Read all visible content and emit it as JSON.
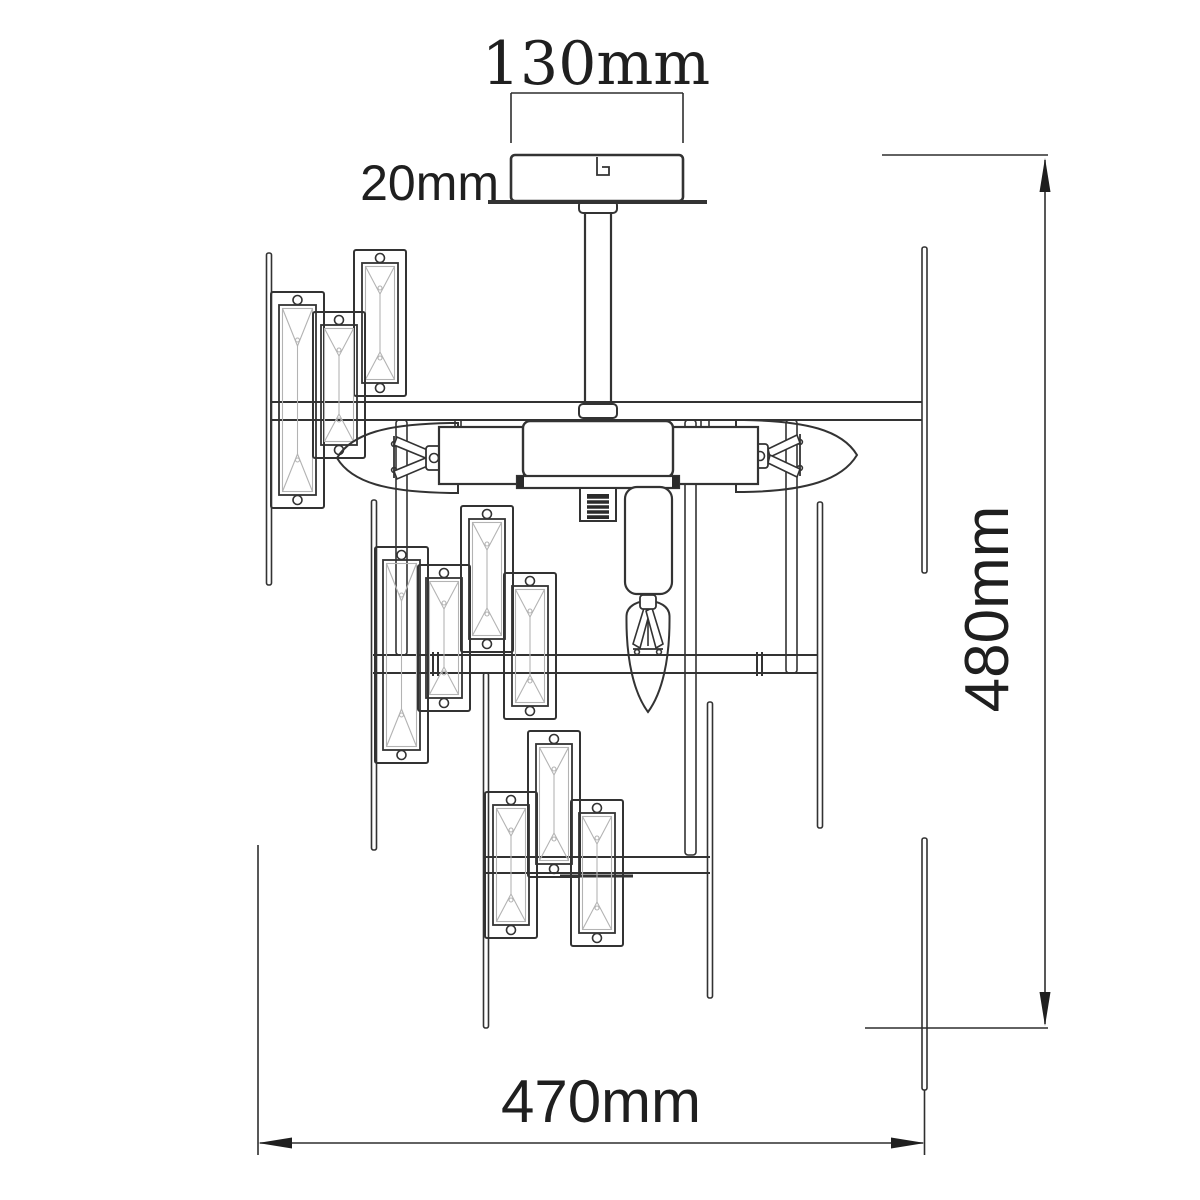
{
  "drawing": {
    "subject": "Crystal chandelier ceiling lamp - technical line drawing, front elevation with dimensions",
    "background_color": "#ffffff",
    "ink_color": "#333333",
    "light_line_color": "#b3b3b3",
    "labels": {
      "canopy_width": "130mm",
      "canopy_height": "20mm",
      "overall_height": "480mm",
      "overall_width": "470mm"
    },
    "parts": {
      "crystal_prisms": 10,
      "candle_bulbs": 3,
      "hanging_rods": 10,
      "tiers": 3
    }
  }
}
